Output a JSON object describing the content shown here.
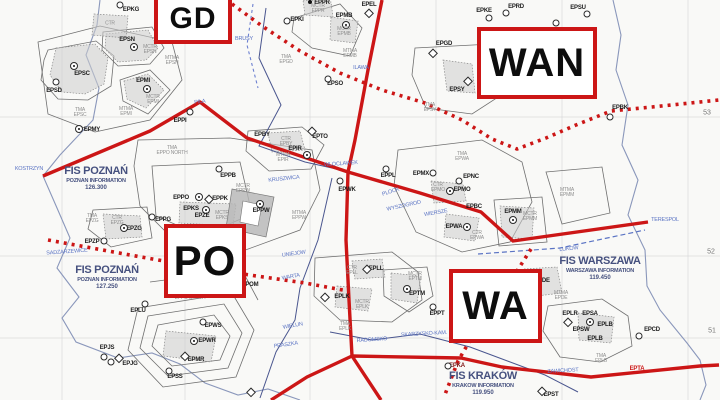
{
  "map": {
    "title": "Poland FIS sectors VFR chart",
    "colors": {
      "boundary_red": "#cc1616",
      "fis_text_navy": "#46517f",
      "town_blue": "#5b74c4",
      "airspace_gray": "#8f8f8f",
      "border_blue": "#8a97bb"
    },
    "sector_boxes": {
      "gd": "GD",
      "wan": "WAN",
      "po": "PO",
      "wa": "WA"
    },
    "fis": [
      {
        "title": "FIS POZNAŃ",
        "sub": "POZNAN INFORMATION",
        "freq": "126.300",
        "x": 96,
        "y": 165
      },
      {
        "title": "FIS POZNAŃ",
        "sub": "POZNAN INFORMATION",
        "freq": "127.250",
        "x": 107,
        "y": 264
      },
      {
        "title": "FIS WARSZAWA",
        "sub": "WARSZAWA INFORMATION",
        "freq": "119.450",
        "x": 600,
        "y": 255
      },
      {
        "title": "FIS KRAKÓW",
        "sub": "KRAKOW INFORMATION",
        "freq": "119.950",
        "x": 483,
        "y": 370
      }
    ],
    "lat_labels": [
      {
        "t": "53",
        "x": 707,
        "y": 113
      },
      {
        "t": "52",
        "x": 711,
        "y": 252
      },
      {
        "t": "51",
        "x": 712,
        "y": 331
      }
    ],
    "airfields": [
      {
        "t": "EPKG",
        "x": 131,
        "y": 10,
        "s": "circle",
        "sx": 120,
        "sy": 5
      },
      {
        "t": "EPSN",
        "x": 127,
        "y": 40,
        "s": "circle-dot",
        "sx": 134,
        "sy": 47
      },
      {
        "t": "EPSC",
        "x": 82,
        "y": 74,
        "s": "circle-dot",
        "sx": 74,
        "sy": 66
      },
      {
        "t": "EPSD",
        "x": 54,
        "y": 91,
        "s": "circle",
        "sx": 56,
        "sy": 82
      },
      {
        "t": "EPMY",
        "x": 92,
        "y": 130,
        "s": "circle-dot",
        "sx": 79,
        "sy": 129
      },
      {
        "t": "EPMI",
        "x": 143,
        "y": 81,
        "s": "circle-dot",
        "sx": 147,
        "sy": 89
      },
      {
        "t": "EPPI",
        "x": 180,
        "y": 121,
        "s": "circle",
        "sx": 190,
        "sy": 112
      },
      {
        "t": "EPPR",
        "x": 322,
        "y": 3,
        "s": "dot",
        "sx": 310,
        "sy": 2
      },
      {
        "t": "EPEL",
        "x": 369,
        "y": 5,
        "s": "diamond",
        "sx": 369,
        "sy": 13
      },
      {
        "t": "EPKI",
        "x": 297,
        "y": 20,
        "s": "circle",
        "sx": 287,
        "sy": 21
      },
      {
        "t": "EPMB",
        "x": 344,
        "y": 16,
        "s": "circle-dot",
        "sx": 346,
        "sy": 25
      },
      {
        "t": "EPGD",
        "x": 444,
        "y": 44,
        "s": "diamond",
        "sx": 433,
        "sy": 53
      },
      {
        "t": "EPSY",
        "x": 457,
        "y": 90,
        "s": "diamond",
        "sx": 468,
        "sy": 81
      },
      {
        "t": "EPSO",
        "x": 335,
        "y": 84,
        "s": "circle",
        "sx": 328,
        "sy": 79
      },
      {
        "t": "EPKE",
        "x": 484,
        "y": 11,
        "s": "circle",
        "sx": 489,
        "sy": 18
      },
      {
        "t": "EPRD",
        "x": 516,
        "y": 7,
        "s": "circle",
        "sx": 506,
        "sy": 13
      },
      {
        "t": "EPSU",
        "x": 578,
        "y": 8,
        "s": "circle",
        "sx": 587,
        "sy": 14
      },
      {
        "t": "EPBK",
        "x": 620,
        "y": 108,
        "s": "circle",
        "sx": 610,
        "sy": 117
      },
      {
        "t": "EPPB",
        "x": 228,
        "y": 176,
        "s": "circle",
        "sx": 219,
        "sy": 169
      },
      {
        "t": "EPPO",
        "x": 181,
        "y": 198,
        "s": "circle-dot",
        "sx": 199,
        "sy": 197
      },
      {
        "t": "EPPK",
        "x": 220,
        "y": 199,
        "s": "diamond",
        "sx": 209,
        "sy": 199
      },
      {
        "t": "EPKS",
        "x": 191,
        "y": 209,
        "s": "circle-dot",
        "sx": 206,
        "sy": 210
      },
      {
        "t": "EPZE",
        "x": 202,
        "y": 216,
        "s": "none"
      },
      {
        "t": "EPPG",
        "x": 163,
        "y": 220,
        "s": "circle",
        "sx": 152,
        "sy": 217
      },
      {
        "t": "EPZG",
        "x": 134,
        "y": 229,
        "s": "circle-dot",
        "sx": 124,
        "sy": 228
      },
      {
        "t": "EPZP",
        "x": 92,
        "y": 242,
        "s": "circle",
        "sx": 104,
        "sy": 241
      },
      {
        "t": "EPBY",
        "x": 262,
        "y": 135,
        "s": "none"
      },
      {
        "t": "EPTO",
        "x": 320,
        "y": 137,
        "s": "diamond",
        "sx": 312,
        "sy": 131
      },
      {
        "t": "EPIR",
        "x": 295,
        "y": 149,
        "s": "circle-dot",
        "sx": 307,
        "sy": 155
      },
      {
        "t": "EPWK",
        "x": 347,
        "y": 190,
        "s": "circle",
        "sx": 340,
        "sy": 181
      },
      {
        "t": "EPPW",
        "x": 261,
        "y": 211,
        "s": "circle-dot",
        "sx": 260,
        "sy": 204
      },
      {
        "t": "EPPL",
        "x": 388,
        "y": 176,
        "s": "circle",
        "sx": 386,
        "sy": 169
      },
      {
        "t": "EPMX",
        "x": 421,
        "y": 174,
        "s": "circle",
        "sx": 433,
        "sy": 173
      },
      {
        "t": "EPNC",
        "x": 471,
        "y": 177,
        "s": "circle",
        "sx": 459,
        "sy": 181
      },
      {
        "t": "EPMO",
        "x": 462,
        "y": 190,
        "s": "circle-dot",
        "sx": 450,
        "sy": 191
      },
      {
        "t": "EPBC",
        "x": 474,
        "y": 207,
        "s": "none"
      },
      {
        "t": "EPWA",
        "x": 454,
        "y": 227,
        "s": "circle-dot",
        "sx": 467,
        "sy": 227
      },
      {
        "t": "EPMM",
        "x": 513,
        "y": 212,
        "s": "circle-dot",
        "sx": 513,
        "sy": 220
      },
      {
        "t": "EPOM",
        "x": 250,
        "y": 285,
        "s": "none"
      },
      {
        "t": "EPLL",
        "x": 376,
        "y": 269,
        "s": "diamond",
        "sx": 367,
        "sy": 269
      },
      {
        "t": "EPLK",
        "x": 342,
        "y": 297,
        "s": "diamond",
        "sx": 325,
        "sy": 297
      },
      {
        "t": "EPPT",
        "x": 437,
        "y": 314,
        "s": "circle",
        "sx": 433,
        "sy": 307
      },
      {
        "t": "EPTM",
        "x": 417,
        "y": 294,
        "s": "circle-dot",
        "sx": 407,
        "sy": 289
      },
      {
        "t": "EPDE",
        "x": 542,
        "y": 281,
        "s": "none"
      },
      {
        "t": "EPLR",
        "x": 570,
        "y": 314,
        "s": "diamond",
        "sx": 568,
        "sy": 322
      },
      {
        "t": "EPSA",
        "x": 590,
        "y": 314,
        "s": "none"
      },
      {
        "t": "EPLB",
        "x": 605,
        "y": 325,
        "s": "circle-dot",
        "sx": 590,
        "sy": 322
      },
      {
        "t": "EPSW",
        "x": 581,
        "y": 330,
        "s": "none"
      },
      {
        "t": "EPLB",
        "x": 595,
        "y": 339,
        "s": "none"
      },
      {
        "t": "EPCD",
        "x": 652,
        "y": 330,
        "s": "circle",
        "sx": 639,
        "sy": 336
      },
      {
        "t": "EPST",
        "x": 551,
        "y": 395,
        "s": "diamond",
        "sx": 542,
        "sy": 391
      },
      {
        "t": "EPLU",
        "x": 138,
        "y": 311,
        "s": "circle",
        "sx": 145,
        "sy": 304
      },
      {
        "t": "EPWS",
        "x": 213,
        "y": 326,
        "s": "circle",
        "sx": 203,
        "sy": 322
      },
      {
        "t": "EPWR",
        "x": 207,
        "y": 341,
        "s": "circle-dot",
        "sx": 194,
        "sy": 341
      },
      {
        "t": "EPMR",
        "x": 196,
        "y": 360,
        "s": "diamond",
        "sx": 185,
        "sy": 356
      },
      {
        "t": "EPSS",
        "x": 175,
        "y": 377,
        "s": "circle",
        "sx": 169,
        "sy": 371
      },
      {
        "t": "EPJS",
        "x": 107,
        "y": 348,
        "s": "circle",
        "sx": 104,
        "sy": 357
      },
      {
        "t": "EPJG",
        "x": 130,
        "y": 364,
        "s": "diamond",
        "sx": 119,
        "sy": 358
      }
    ],
    "special_labels": [
      {
        "t": "EPKA",
        "x": 457,
        "y": 366,
        "s": "circle",
        "sx": 448,
        "sy": 366,
        "cls": "dark"
      },
      {
        "t": "EPTA",
        "x": 637,
        "y": 369,
        "s": "none",
        "cls": "redtxt"
      }
    ],
    "extra_symbols": [
      {
        "s": "circle",
        "x": 556,
        "y": 23
      },
      {
        "s": "circle",
        "x": 111,
        "y": 362
      },
      {
        "s": "diamond",
        "x": 251,
        "y": 392
      }
    ],
    "airspace_labels": [
      {
        "t": "CTR",
        "x": 110,
        "y": 24
      },
      {
        "t": "MCTR\nEPSN",
        "x": 150,
        "y": 50
      },
      {
        "t": "MTMA\nEPSN",
        "x": 172,
        "y": 61
      },
      {
        "t": "TMA\nEPSC",
        "x": 80,
        "y": 113
      },
      {
        "t": "MTMA\nEPMI",
        "x": 126,
        "y": 112
      },
      {
        "t": "MCTR\nEPMI",
        "x": 153,
        "y": 100
      },
      {
        "t": "MCTR\nEPPR",
        "x": 318,
        "y": 9
      },
      {
        "t": "MCTR\nEPMB",
        "x": 344,
        "y": 32
      },
      {
        "t": "MTMA\nEPMB",
        "x": 350,
        "y": 54
      },
      {
        "t": "TMA\nEPGD",
        "x": 286,
        "y": 60
      },
      {
        "t": "TMA\nEPSY",
        "x": 430,
        "y": 108
      },
      {
        "t": "TMA\nEPPO NORTH",
        "x": 172,
        "y": 151
      },
      {
        "t": "MTMA\nEPIR",
        "x": 283,
        "y": 158
      },
      {
        "t": "CTR\nEPBY",
        "x": 286,
        "y": 142
      },
      {
        "t": "MCTR\nEPKS",
        "x": 222,
        "y": 216
      },
      {
        "t": "CTR\nEPZG",
        "x": 117,
        "y": 221
      },
      {
        "t": "TMA\nEPZG",
        "x": 92,
        "y": 219
      },
      {
        "t": "MCTR\nEPPW",
        "x": 243,
        "y": 189
      },
      {
        "t": "MTMA\nEPPW",
        "x": 299,
        "y": 216
      },
      {
        "t": "TMA\nEPWA",
        "x": 462,
        "y": 157
      },
      {
        "t": "CTR\nEPMO",
        "x": 438,
        "y": 188
      },
      {
        "t": "CTR\nEPWA",
        "x": 477,
        "y": 236
      },
      {
        "t": "MCTR\nEPMM",
        "x": 530,
        "y": 217
      },
      {
        "t": "MTMA\nEPMM",
        "x": 567,
        "y": 193
      },
      {
        "t": "MTMA\nEPDE",
        "x": 561,
        "y": 296
      },
      {
        "t": "TMA\nEPLB",
        "x": 601,
        "y": 359
      },
      {
        "t": "CTR\nEPLL",
        "x": 352,
        "y": 271
      },
      {
        "t": "MCTR\nEPLK",
        "x": 362,
        "y": 305
      },
      {
        "t": "TMA\nEPLK",
        "x": 345,
        "y": 327
      },
      {
        "t": "MCTR\nEPTM",
        "x": 415,
        "y": 277
      },
      {
        "t": "TMA\nEPPO SOUTH",
        "x": 190,
        "y": 296
      }
    ],
    "towns": [
      {
        "t": "KOSTRZYN",
        "x": 29,
        "y": 170,
        "r": 0
      },
      {
        "t": "PILA",
        "x": 200,
        "y": 103,
        "r": -8
      },
      {
        "t": "BRUSY",
        "x": 244,
        "y": 40,
        "r": 0
      },
      {
        "t": "ILAWA",
        "x": 361,
        "y": 69,
        "r": 0
      },
      {
        "t": "WLOCLAWEK",
        "x": 341,
        "y": 165,
        "r": -4
      },
      {
        "t": "KRUSZWICA",
        "x": 284,
        "y": 180,
        "r": -6
      },
      {
        "t": "PLOCK",
        "x": 391,
        "y": 193,
        "r": -18
      },
      {
        "t": "WYSZOGROD",
        "x": 404,
        "y": 207,
        "r": -12
      },
      {
        "t": "WIERSZE",
        "x": 436,
        "y": 214,
        "r": -10
      },
      {
        "t": "TERESPOL",
        "x": 665,
        "y": 221,
        "r": 0
      },
      {
        "t": "LUKOW",
        "x": 569,
        "y": 250,
        "r": -6
      },
      {
        "t": "UNIEJOW",
        "x": 294,
        "y": 255,
        "r": -8
      },
      {
        "t": "WARTA",
        "x": 291,
        "y": 278,
        "r": -10
      },
      {
        "t": "WIELUN",
        "x": 293,
        "y": 327,
        "r": -10
      },
      {
        "t": "PRASZKA",
        "x": 286,
        "y": 346,
        "r": -8
      },
      {
        "t": "RADOMSKO",
        "x": 372,
        "y": 341,
        "r": -4
      },
      {
        "t": "SKARZYSKO-KAM.",
        "x": 424,
        "y": 335,
        "r": -3
      },
      {
        "t": "WACHOCK",
        "x": 495,
        "y": 342,
        "r": -3
      },
      {
        "t": "ZAWICHOST",
        "x": 563,
        "y": 372,
        "r": -3
      },
      {
        "t": "SADZARZEWICE",
        "x": 67,
        "y": 253,
        "r": -4
      }
    ]
  }
}
